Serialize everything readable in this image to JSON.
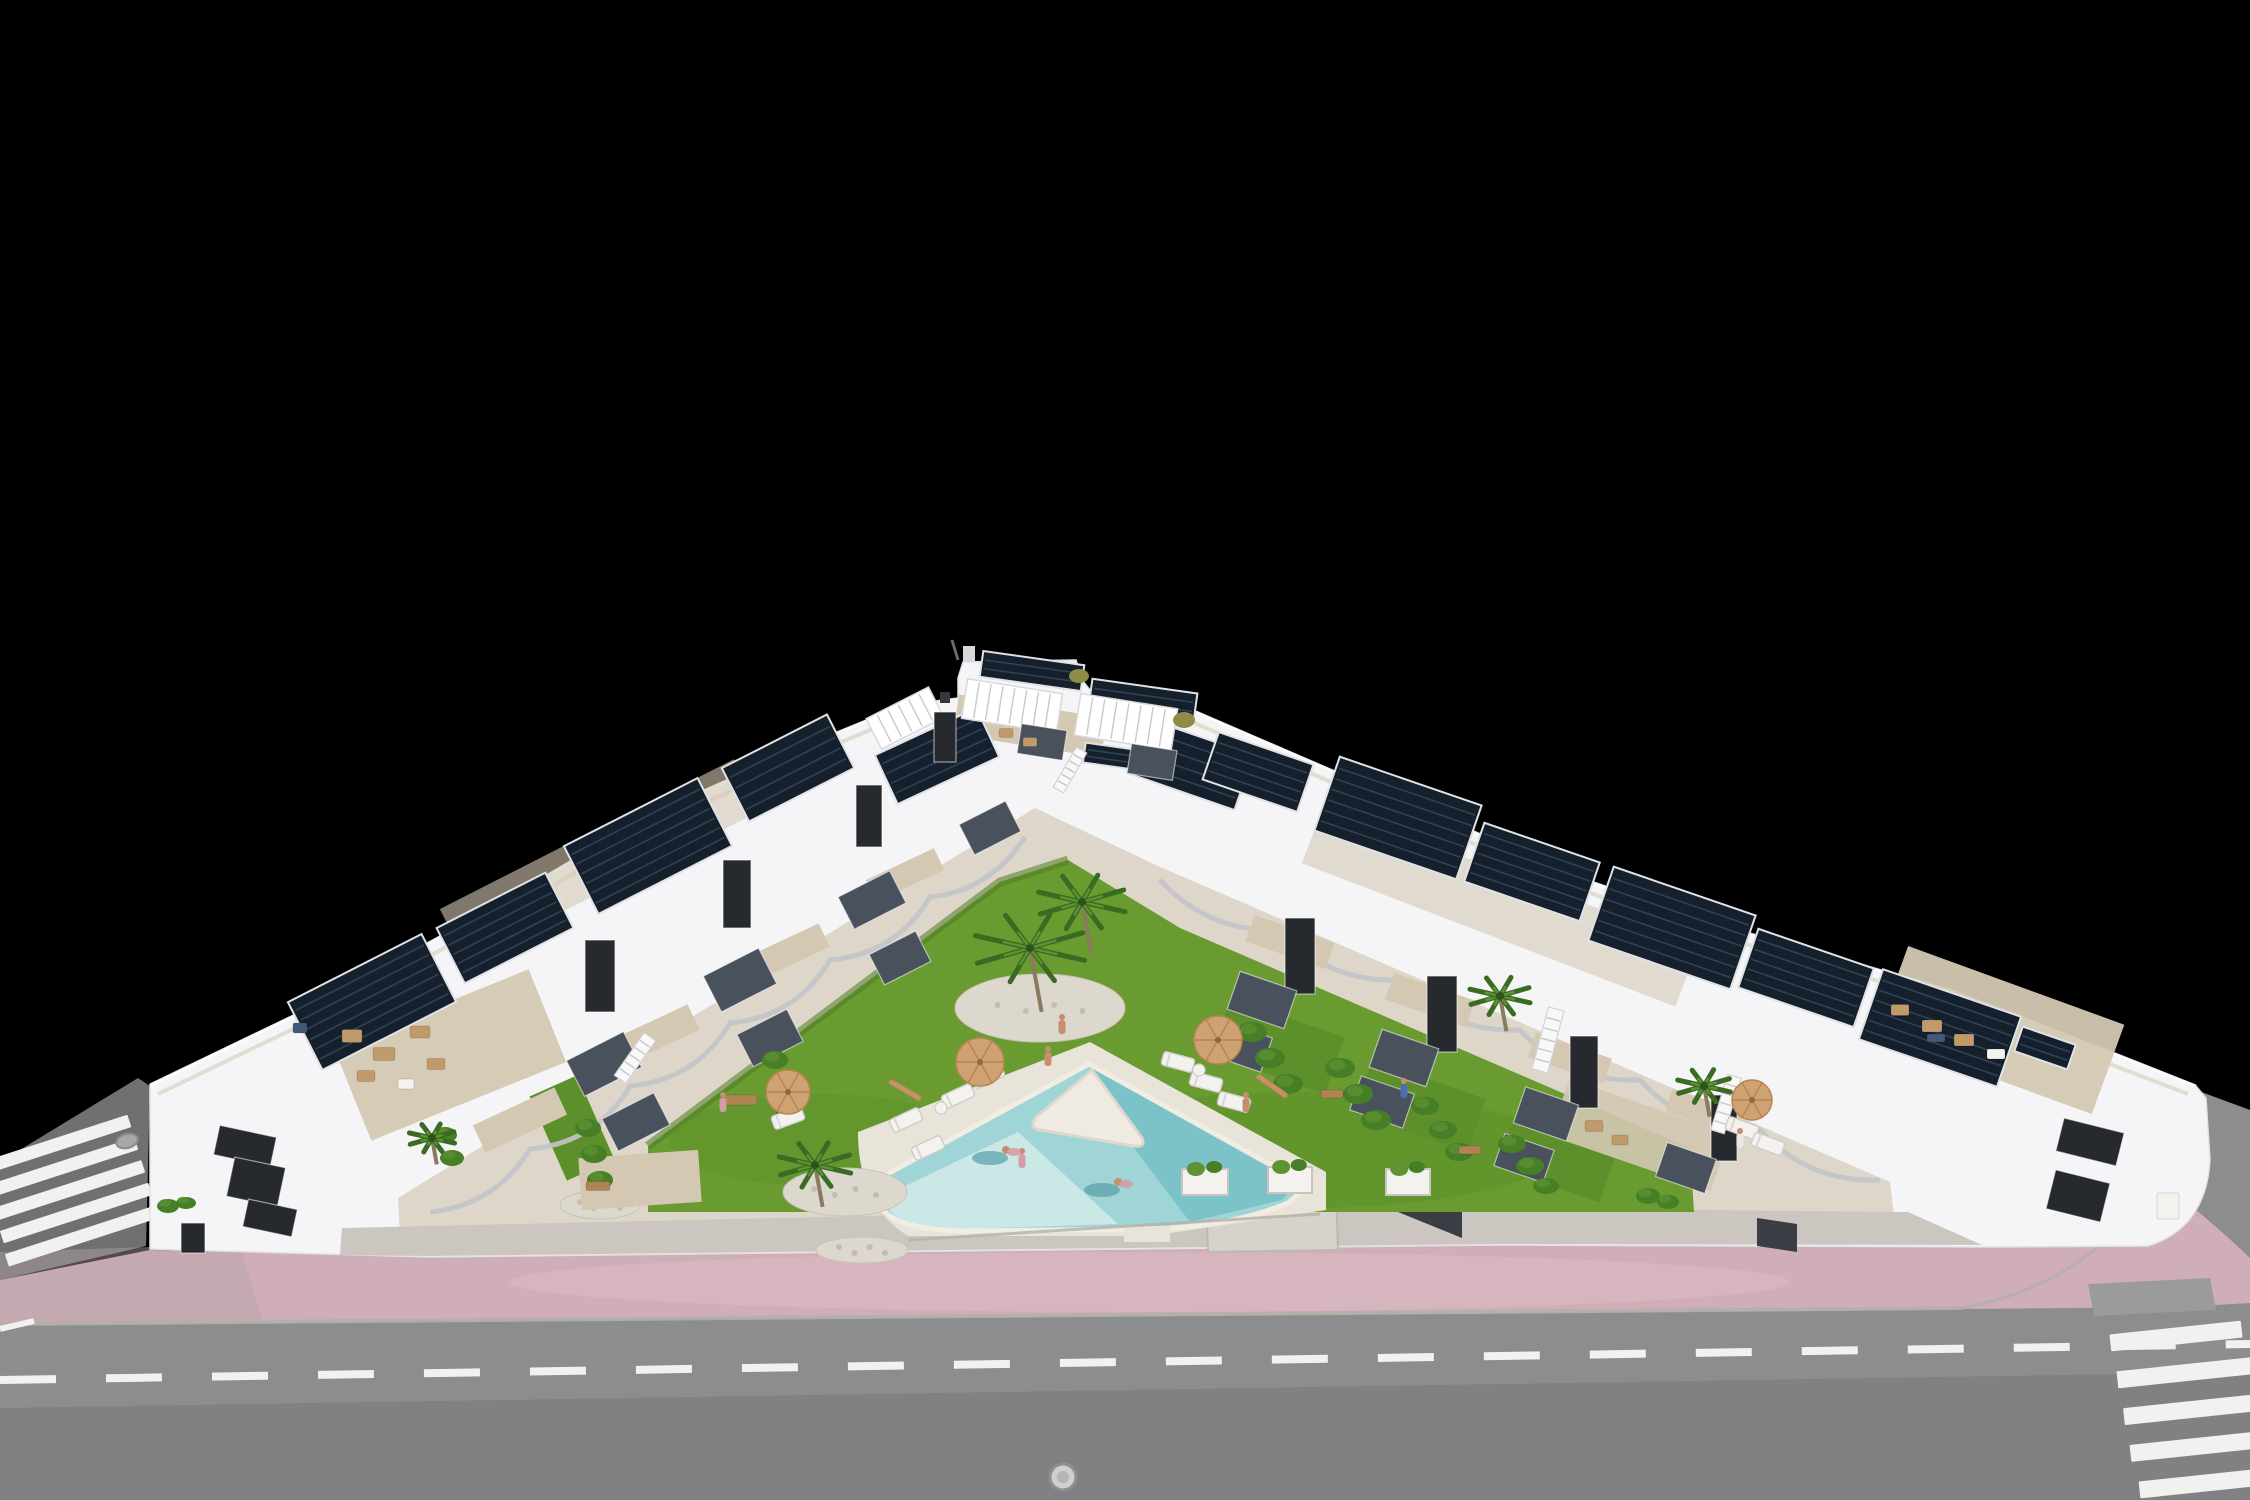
{
  "image": {
    "title": "Aerial 3D render of a modern white townhouse complex",
    "description": "Night-isolated architectural visualization: a V-shaped row of white modern townhouses with rooftop solar panels and roof terraces surrounds a central landscaped courtyard with lawn, palm trees, sun loungers, umbrellas and a triangular swimming pool with a white island wedge. A pink paved sidewalk and a gray asphalt road with dashed lane markings and zebra crosswalks run along the bottom; background is solid black."
  },
  "colors": {
    "background": "#000000",
    "road": "#8b8d8e",
    "side_road": "#6e7072",
    "marking": "#f1f2f0",
    "curb": "#b2afa9",
    "pink": "#d0aeb9",
    "pink_light": "#ddbcc5",
    "pink_gray": "#b5a3a9",
    "driveway": "#9b9b99",
    "building_white": "#f5f5f7",
    "building_bright": "#ffffff",
    "building_shadow": "#d9dade",
    "courtyard": "#ded7c9",
    "walkway": "#cbc7c0",
    "walkway_light": "#d7d3cc",
    "terrace": "#d4c8b2",
    "window_dark": "#26292e",
    "glass": "#49525c",
    "accent_dark": "#3a3e44",
    "solar_panel": "#16202c",
    "panel_stripe": "#2f4257",
    "panel_frame": "#dfe3e6",
    "pergola_slat": "#c9c9cd",
    "lawn": "#699b31",
    "lawn_patch": "#5d8f2b",
    "lawn_dark": "#4f7c24",
    "hedge": "#477f26",
    "hedge_light": "#5e9233",
    "palm": "#3a6b22",
    "palm_light": "#5e9233",
    "trunk": "#8a7a5f",
    "rock": "#dcd8ce",
    "pebble": "#c2bdb1",
    "pool_mid": "#9fd5d6",
    "pool_deep": "#77c1c8",
    "pool_shallow": "#cde9e6",
    "pool_island": "#efebe2",
    "pool_deck": "#e9e4d9",
    "pool_coping": "#f1ede3",
    "umbrella": "#cfa173",
    "umbrella_dark": "#b5854f",
    "furn_tan": "#c09a6b",
    "furn_white": "#f3f2ef",
    "furn_wood": "#b08355",
    "furn_blue": "#41597a",
    "skin": "#c68d6e",
    "person_pink": "#d39ca6",
    "person_blue": "#4a6fae",
    "person_white": "#e9e7e4",
    "olive_plant": "#8e8c46",
    "swim_shadow": "#57a0a8"
  },
  "scene": {
    "solar_panels": [
      {
        "x": 372,
        "y": 1002,
        "w": 150,
        "h": 76,
        "r": -27
      },
      {
        "x": 505,
        "y": 928,
        "w": 122,
        "h": 62,
        "r": -27
      },
      {
        "x": 648,
        "y": 846,
        "w": 150,
        "h": 76,
        "r": -27
      },
      {
        "x": 788,
        "y": 768,
        "w": 118,
        "h": 60,
        "r": -27
      },
      {
        "x": 937,
        "y": 756,
        "w": 112,
        "h": 54,
        "r": -25
      },
      {
        "x": 1032,
        "y": 671,
        "w": 102,
        "h": 26,
        "r": 8
      },
      {
        "x": 1143,
        "y": 700,
        "w": 106,
        "h": 28,
        "r": 8
      },
      {
        "x": 1116,
        "y": 757,
        "w": 64,
        "h": 20,
        "r": 8
      },
      {
        "x": 1190,
        "y": 764,
        "w": 114,
        "h": 58,
        "r": 19
      },
      {
        "x": 1258,
        "y": 772,
        "w": 100,
        "h": 50,
        "r": 19
      },
      {
        "x": 1398,
        "y": 818,
        "w": 150,
        "h": 78,
        "r": 19
      },
      {
        "x": 1532,
        "y": 872,
        "w": 122,
        "h": 62,
        "r": 19
      },
      {
        "x": 1672,
        "y": 928,
        "w": 150,
        "h": 78,
        "r": 19
      },
      {
        "x": 1806,
        "y": 978,
        "w": 122,
        "h": 62,
        "r": 19
      },
      {
        "x": 1940,
        "y": 1028,
        "w": 146,
        "h": 74,
        "r": 19
      },
      {
        "x": 2045,
        "y": 1048,
        "w": 56,
        "h": 26,
        "r": 19
      }
    ],
    "pergolas": [
      {
        "x": 1012,
        "y": 706,
        "w": 96,
        "h": 40,
        "r": 9
      },
      {
        "x": 1126,
        "y": 722,
        "w": 98,
        "h": 42,
        "r": 9
      },
      {
        "x": 905,
        "y": 718,
        "w": 70,
        "h": 34,
        "r": -27
      }
    ],
    "terraces": [
      {
        "x": 450,
        "y": 1055,
        "w": 210,
        "h": 100,
        "r": -22,
        "o": 0.95
      },
      {
        "x": 600,
        "y": 860,
        "w": 330,
        "h": 58,
        "r": -27,
        "o": 0.6
      },
      {
        "x": 520,
        "y": 1120,
        "w": 90,
        "h": 30,
        "r": -25,
        "o": 1
      },
      {
        "x": 655,
        "y": 1035,
        "w": 85,
        "h": 28,
        "r": -25,
        "o": 1
      },
      {
        "x": 788,
        "y": 952,
        "w": 80,
        "h": 26,
        "r": -25,
        "o": 1
      },
      {
        "x": 905,
        "y": 875,
        "w": 75,
        "h": 24,
        "r": -25,
        "o": 1
      },
      {
        "x": 640,
        "y": 1180,
        "w": 120,
        "h": 52,
        "r": -4,
        "o": 1
      },
      {
        "x": 1030,
        "y": 726,
        "w": 150,
        "h": 40,
        "r": 9,
        "o": 1
      },
      {
        "x": 1290,
        "y": 942,
        "w": 85,
        "h": 28,
        "r": 19,
        "o": 1
      },
      {
        "x": 1430,
        "y": 1000,
        "w": 85,
        "h": 28,
        "r": 19,
        "o": 1
      },
      {
        "x": 1570,
        "y": 1058,
        "w": 80,
        "h": 26,
        "r": 19,
        "o": 1
      },
      {
        "x": 1705,
        "y": 1112,
        "w": 76,
        "h": 24,
        "r": 19,
        "o": 1
      },
      {
        "x": 1640,
        "y": 1135,
        "w": 170,
        "h": 60,
        "r": 19,
        "o": 0.9
      },
      {
        "x": 1500,
        "y": 905,
        "w": 400,
        "h": 64,
        "r": 21,
        "o": 0.6
      },
      {
        "x": 2000,
        "y": 1030,
        "w": 230,
        "h": 95,
        "r": 20,
        "o": 0.95
      }
    ],
    "lawn_patches": [
      {
        "x": 572,
        "y": 1128,
        "w": 52,
        "h": 92,
        "r": -24
      },
      {
        "x": 1278,
        "y": 1046,
        "w": 120,
        "h": 60,
        "r": 19
      },
      {
        "x": 1420,
        "y": 1106,
        "w": 120,
        "h": 56,
        "r": 19
      },
      {
        "x": 1556,
        "y": 1162,
        "w": 108,
        "h": 48,
        "r": 19
      }
    ],
    "windows": [
      {
        "x": 604,
        "y": 1064,
        "w": 64,
        "h": 40,
        "r": -27,
        "t": "g"
      },
      {
        "x": 740,
        "y": 980,
        "w": 62,
        "h": 40,
        "r": -27,
        "t": "g"
      },
      {
        "x": 872,
        "y": 900,
        "w": 58,
        "h": 36,
        "r": -27,
        "t": "g"
      },
      {
        "x": 990,
        "y": 828,
        "w": 52,
        "h": 34,
        "r": -27,
        "t": "g"
      },
      {
        "x": 636,
        "y": 1122,
        "w": 58,
        "h": 36,
        "r": -27,
        "t": "g"
      },
      {
        "x": 770,
        "y": 1038,
        "w": 56,
        "h": 36,
        "r": -27,
        "t": "g"
      },
      {
        "x": 900,
        "y": 958,
        "w": 52,
        "h": 34,
        "r": -27,
        "t": "g"
      },
      {
        "x": 600,
        "y": 976,
        "w": 30,
        "h": 72,
        "r": 0,
        "t": "d"
      },
      {
        "x": 737,
        "y": 894,
        "w": 28,
        "h": 68,
        "r": 0,
        "t": "d"
      },
      {
        "x": 869,
        "y": 816,
        "w": 26,
        "h": 62,
        "r": 0,
        "t": "d"
      },
      {
        "x": 945,
        "y": 737,
        "w": 22,
        "h": 50,
        "r": 0,
        "t": "d"
      },
      {
        "x": 1300,
        "y": 956,
        "w": 30,
        "h": 76,
        "r": 0,
        "t": "d"
      },
      {
        "x": 1442,
        "y": 1014,
        "w": 30,
        "h": 76,
        "r": 0,
        "t": "d"
      },
      {
        "x": 1584,
        "y": 1072,
        "w": 28,
        "h": 72,
        "r": 0,
        "t": "d"
      },
      {
        "x": 1724,
        "y": 1128,
        "w": 26,
        "h": 66,
        "r": 0,
        "t": "d"
      },
      {
        "x": 1262,
        "y": 1000,
        "w": 60,
        "h": 40,
        "r": 19,
        "t": "g"
      },
      {
        "x": 1404,
        "y": 1058,
        "w": 60,
        "h": 40,
        "r": 19,
        "t": "g"
      },
      {
        "x": 1546,
        "y": 1114,
        "w": 56,
        "h": 38,
        "r": 19,
        "t": "g"
      },
      {
        "x": 1686,
        "y": 1168,
        "w": 52,
        "h": 36,
        "r": 19,
        "t": "g"
      },
      {
        "x": 1240,
        "y": 1046,
        "w": 56,
        "h": 36,
        "r": 19,
        "t": "g"
      },
      {
        "x": 1382,
        "y": 1102,
        "w": 56,
        "h": 36,
        "r": 19,
        "t": "g"
      },
      {
        "x": 1524,
        "y": 1158,
        "w": 52,
        "h": 34,
        "r": 19,
        "t": "g"
      },
      {
        "x": 1042,
        "y": 742,
        "w": 46,
        "h": 30,
        "r": 9,
        "t": "g"
      },
      {
        "x": 1152,
        "y": 762,
        "w": 46,
        "h": 30,
        "r": 9,
        "t": "g"
      },
      {
        "x": 245,
        "y": 1146,
        "w": 58,
        "h": 30,
        "r": 12,
        "t": "d"
      },
      {
        "x": 256,
        "y": 1182,
        "w": 52,
        "h": 40,
        "r": 12,
        "t": "d"
      },
      {
        "x": 270,
        "y": 1218,
        "w": 50,
        "h": 28,
        "r": 12,
        "t": "d"
      },
      {
        "x": 193,
        "y": 1238,
        "w": 24,
        "h": 30,
        "r": 0,
        "t": "d"
      },
      {
        "x": 2090,
        "y": 1142,
        "w": 62,
        "h": 34,
        "r": 14,
        "t": "d"
      },
      {
        "x": 2078,
        "y": 1196,
        "w": 56,
        "h": 40,
        "r": 14,
        "t": "d"
      }
    ],
    "stairs": [
      {
        "x": 635,
        "y": 1058,
        "len": 52,
        "w": 14,
        "r": -55
      },
      {
        "x": 1070,
        "y": 770,
        "len": 46,
        "w": 12,
        "r": -60
      },
      {
        "x": 1548,
        "y": 1040,
        "len": 64,
        "w": 16,
        "r": -75
      },
      {
        "x": 1726,
        "y": 1104,
        "len": 58,
        "w": 14,
        "r": -73
      }
    ],
    "hedges": [
      {
        "x": 1252,
        "y": 1032,
        "rx": 15,
        "ry": 10
      },
      {
        "x": 1270,
        "y": 1058,
        "rx": 15,
        "ry": 10
      },
      {
        "x": 1288,
        "y": 1084,
        "rx": 15,
        "ry": 10
      },
      {
        "x": 1340,
        "y": 1068,
        "rx": 15,
        "ry": 10
      },
      {
        "x": 1358,
        "y": 1094,
        "rx": 15,
        "ry": 10
      },
      {
        "x": 1376,
        "y": 1120,
        "rx": 15,
        "ry": 10
      },
      {
        "x": 1425,
        "y": 1106,
        "rx": 14,
        "ry": 9
      },
      {
        "x": 1443,
        "y": 1130,
        "rx": 14,
        "ry": 9
      },
      {
        "x": 1459,
        "y": 1152,
        "rx": 14,
        "ry": 9
      },
      {
        "x": 1512,
        "y": 1144,
        "rx": 14,
        "ry": 9
      },
      {
        "x": 1530,
        "y": 1166,
        "rx": 14,
        "ry": 9
      },
      {
        "x": 1546,
        "y": 1186,
        "rx": 13,
        "ry": 8
      },
      {
        "x": 588,
        "y": 1128,
        "rx": 13,
        "ry": 9
      },
      {
        "x": 594,
        "y": 1154,
        "rx": 13,
        "ry": 9
      },
      {
        "x": 600,
        "y": 1180,
        "rx": 13,
        "ry": 9
      },
      {
        "x": 775,
        "y": 1060,
        "rx": 13,
        "ry": 9
      },
      {
        "x": 782,
        "y": 1086,
        "rx": 13,
        "ry": 9
      },
      {
        "x": 789,
        "y": 1112,
        "rx": 13,
        "ry": 9
      },
      {
        "x": 168,
        "y": 1206,
        "rx": 11,
        "ry": 7
      },
      {
        "x": 186,
        "y": 1203,
        "rx": 10,
        "ry": 6
      },
      {
        "x": 1648,
        "y": 1196,
        "rx": 12,
        "ry": 8
      },
      {
        "x": 1668,
        "y": 1202,
        "rx": 11,
        "ry": 7
      },
      {
        "x": 445,
        "y": 1135,
        "rx": 12,
        "ry": 8
      },
      {
        "x": 452,
        "y": 1158,
        "rx": 12,
        "ry": 8
      }
    ],
    "olive_plants": [
      {
        "x": 1079,
        "y": 676,
        "rx": 10,
        "ry": 7
      },
      {
        "x": 1184,
        "y": 720,
        "rx": 11,
        "ry": 8
      }
    ],
    "planters": [
      {
        "x": 1205,
        "y": 1182,
        "w": 46,
        "h": 26
      },
      {
        "x": 1290,
        "y": 1180,
        "w": 44,
        "h": 26
      },
      {
        "x": 1408,
        "y": 1182,
        "w": 44,
        "h": 26
      }
    ],
    "rocks": [
      {
        "x": 845,
        "y": 1192,
        "rx": 62,
        "ry": 24
      },
      {
        "x": 600,
        "y": 1205,
        "rx": 40,
        "ry": 14
      },
      {
        "x": 1040,
        "y": 1008,
        "rx": 85,
        "ry": 34
      },
      {
        "x": 862,
        "y": 1250,
        "rx": 46,
        "ry": 13
      }
    ],
    "palms": [
      {
        "x": 1030,
        "y": 948,
        "s": 58
      },
      {
        "x": 1082,
        "y": 902,
        "s": 46
      },
      {
        "x": 815,
        "y": 1165,
        "s": 38
      },
      {
        "x": 1500,
        "y": 996,
        "s": 32
      },
      {
        "x": 1704,
        "y": 1086,
        "s": 28
      },
      {
        "x": 432,
        "y": 1138,
        "s": 24
      }
    ],
    "furniture": [
      {
        "x": 352,
        "y": 1036,
        "w": 20,
        "h": 13,
        "c": "t"
      },
      {
        "x": 384,
        "y": 1054,
        "w": 22,
        "h": 13,
        "c": "t"
      },
      {
        "x": 420,
        "y": 1032,
        "w": 20,
        "h": 12,
        "c": "t"
      },
      {
        "x": 366,
        "y": 1076,
        "w": 18,
        "h": 11,
        "c": "t"
      },
      {
        "x": 436,
        "y": 1064,
        "w": 18,
        "h": 11,
        "c": "t"
      },
      {
        "x": 300,
        "y": 1028,
        "w": 14,
        "h": 10,
        "c": "u"
      },
      {
        "x": 406,
        "y": 1084,
        "w": 16,
        "h": 10,
        "c": "w"
      },
      {
        "x": 1900,
        "y": 1010,
        "w": 18,
        "h": 11,
        "c": "t"
      },
      {
        "x": 1932,
        "y": 1026,
        "w": 20,
        "h": 12,
        "c": "t"
      },
      {
        "x": 1964,
        "y": 1040,
        "w": 20,
        "h": 12,
        "c": "t"
      },
      {
        "x": 1996,
        "y": 1054,
        "w": 18,
        "h": 10,
        "c": "w"
      },
      {
        "x": 1936,
        "y": 1038,
        "w": 18,
        "h": 8,
        "c": "u"
      },
      {
        "x": 1006,
        "y": 733,
        "w": 14,
        "h": 9,
        "c": "t"
      },
      {
        "x": 1030,
        "y": 742,
        "w": 14,
        "h": 9,
        "c": "t"
      },
      {
        "x": 1594,
        "y": 1126,
        "w": 18,
        "h": 11,
        "c": "t"
      },
      {
        "x": 1620,
        "y": 1140,
        "w": 16,
        "h": 10,
        "c": "t"
      },
      {
        "x": 740,
        "y": 1100,
        "w": 34,
        "h": 10,
        "c": "b"
      },
      {
        "x": 1332,
        "y": 1094,
        "w": 22,
        "h": 8,
        "c": "b"
      },
      {
        "x": 1470,
        "y": 1150,
        "w": 22,
        "h": 8,
        "c": "b"
      },
      {
        "x": 598,
        "y": 1186,
        "w": 24,
        "h": 9,
        "c": "b"
      },
      {
        "x": 2168,
        "y": 1206,
        "w": 22,
        "h": 26,
        "c": "w"
      }
    ],
    "loungers": [
      {
        "x": 906,
        "y": 1120,
        "r": -25
      },
      {
        "x": 928,
        "y": 1148,
        "r": -25
      },
      {
        "x": 958,
        "y": 1096,
        "r": -25
      },
      {
        "x": 988,
        "y": 1076,
        "r": -25
      },
      {
        "x": 1178,
        "y": 1062,
        "r": 15
      },
      {
        "x": 1206,
        "y": 1082,
        "r": 15
      },
      {
        "x": 1234,
        "y": 1102,
        "r": 15
      },
      {
        "x": 788,
        "y": 1118,
        "r": -20
      },
      {
        "x": 1742,
        "y": 1128,
        "r": 20
      },
      {
        "x": 1768,
        "y": 1144,
        "r": 20
      }
    ],
    "side_tables": [
      {
        "x": 941,
        "y": 1108
      },
      {
        "x": 1199,
        "y": 1070
      }
    ],
    "umbrellas_open": [
      {
        "x": 980,
        "y": 1062,
        "s": 24
      },
      {
        "x": 1218,
        "y": 1040,
        "s": 24
      },
      {
        "x": 788,
        "y": 1092,
        "s": 22
      },
      {
        "x": 1752,
        "y": 1100,
        "s": 20
      }
    ],
    "umbrellas_closed": [
      {
        "x": 905,
        "y": 1090,
        "r": -60
      },
      {
        "x": 1272,
        "y": 1086,
        "r": -55
      }
    ],
    "people": [
      {
        "x": 1048,
        "y": 1058,
        "c": "skin"
      },
      {
        "x": 1062,
        "y": 1026,
        "c": "skin"
      },
      {
        "x": 1404,
        "y": 1090,
        "c": "blue"
      },
      {
        "x": 723,
        "y": 1104,
        "c": "pink"
      },
      {
        "x": 1022,
        "y": 1160,
        "c": "pink"
      },
      {
        "x": 1246,
        "y": 1104,
        "c": "skin"
      },
      {
        "x": 1740,
        "y": 1140,
        "c": "white"
      }
    ],
    "swimmers": [
      {
        "x": 1006,
        "y": 1150
      },
      {
        "x": 1118,
        "y": 1182
      }
    ],
    "crosswalk_left": [
      {
        "x": 58,
        "y": 1144,
        "w": 150,
        "h": 13,
        "r": -18
      },
      {
        "x": 64,
        "y": 1167,
        "w": 152,
        "h": 13,
        "r": -18
      },
      {
        "x": 70,
        "y": 1190,
        "w": 154,
        "h": 13,
        "r": -18
      },
      {
        "x": 76,
        "y": 1213,
        "w": 156,
        "h": 13,
        "r": -18
      },
      {
        "x": 82,
        "y": 1236,
        "w": 158,
        "h": 13,
        "r": -18
      }
    ],
    "crosswalk_right": [
      {
        "x": 2176,
        "y": 1336,
        "w": 132,
        "h": 17,
        "r": -6
      },
      {
        "x": 2192,
        "y": 1372,
        "w": 150,
        "h": 17,
        "r": -6
      },
      {
        "x": 2206,
        "y": 1408,
        "w": 165,
        "h": 17,
        "r": -6
      },
      {
        "x": 2220,
        "y": 1444,
        "w": 180,
        "h": 17,
        "r": -6
      },
      {
        "x": 2234,
        "y": 1480,
        "w": 190,
        "h": 17,
        "r": -6
      }
    ]
  }
}
